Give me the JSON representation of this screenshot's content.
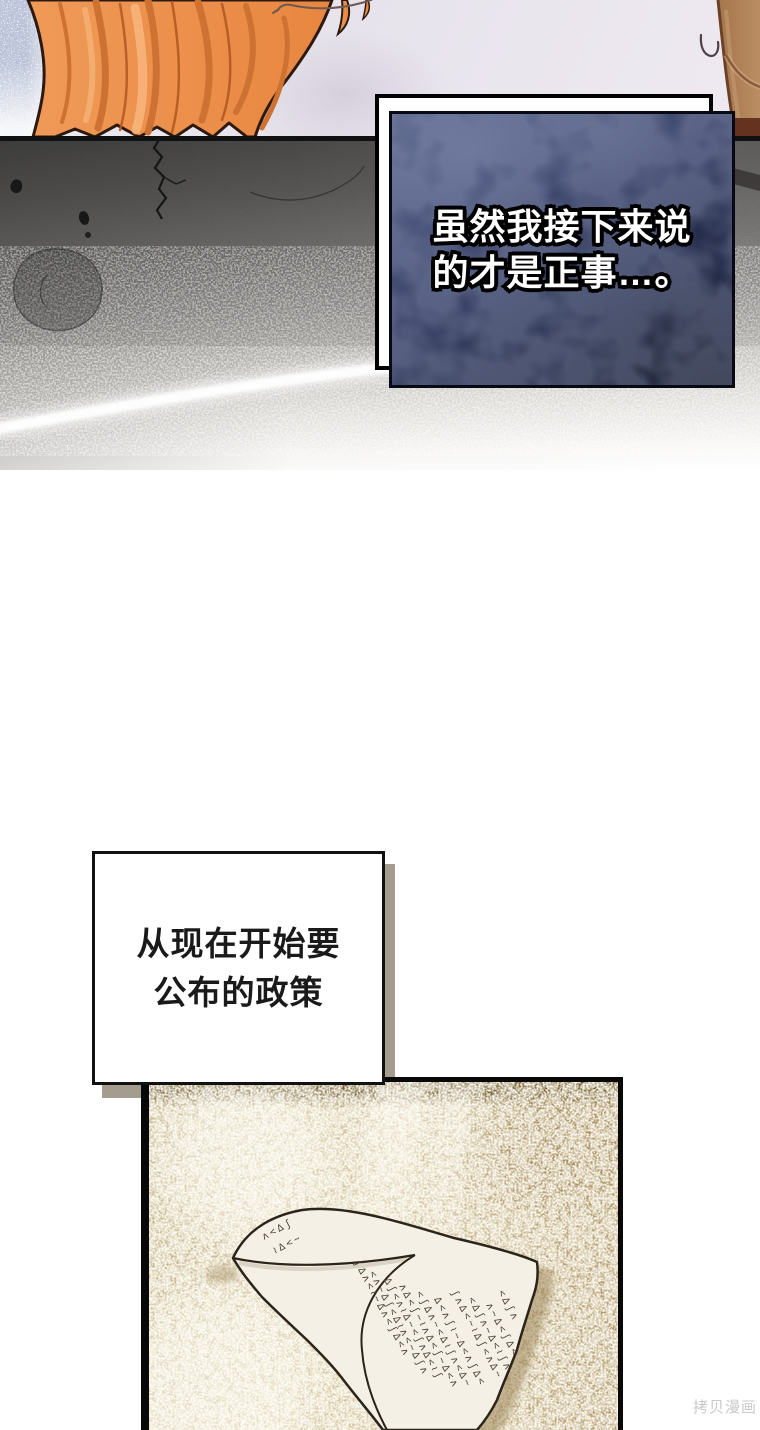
{
  "dark_box": {
    "line1": "虽然我接下来说",
    "line2": "的才是正事…。"
  },
  "light_box": {
    "line1": "从现在开始要",
    "line2": "公布的政策"
  },
  "watermark": {
    "text": "拷贝漫画"
  },
  "scribbles": {
    "rows": [
      "ʌ<∆ʃ",
      "≀∆<~",
      "ʃ∆ʌ<≀~∆ʌ<ʃ∆<ʌ",
      "<ʌ~∆ʃ<∆≀ʌ<~∆ʃʌ",
      "∆ʃ<ʌ≀∆~<ʃʌ∆<≀ʃ",
      "ʌ∆<ʃ~≀ʌ∆<ʃ~∆<ʌ",
      "<ʃ∆ʌ~<∆≀ʃʌ<∆~",
      "∆<ʌʃ≀~∆<ʌʃ∆<",
      "ʃʌ∆<~≀∆ʃ<ʌ∆~",
      "<∆ʃʌ~∆<≀ʃʌ",
      "ʌ~∆<ʃ∆<",
      "<∆ʃʌ"
    ]
  },
  "colors": {
    "hair_orange": "#ef9a55",
    "hair_shadow": "#cd7233",
    "skin_lavender": "#e7e3ec",
    "navy_box": "#1c2340",
    "dark_panel_top": "#474645",
    "bottom_panel_tan": "#cfbd96",
    "paper": "#f5f0e6",
    "watermark_gray": "#c9c9c9"
  }
}
